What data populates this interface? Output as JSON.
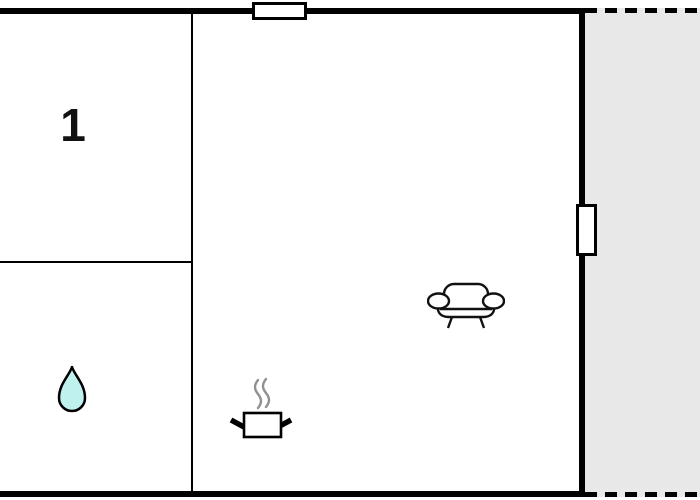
{
  "floorplan": {
    "type": "floor-plan",
    "colors": {
      "wall": "#000000",
      "floor": "#ffffff",
      "terrace_fill": "#e8e8e8",
      "water_drop_fill": "#bff2ef",
      "steam": "#909090"
    },
    "rooms": [
      {
        "id": "bedroom-1",
        "label": "1"
      },
      {
        "id": "bathroom",
        "icon": "water-drop-icon"
      },
      {
        "id": "living-room-kitchen",
        "icons": [
          "cooking-pot-icon",
          "sofa-icon"
        ]
      },
      {
        "id": "terrace",
        "outline": "dashed"
      }
    ],
    "openings": [
      {
        "id": "window-top-wall"
      },
      {
        "id": "window-right-wall"
      }
    ]
  }
}
